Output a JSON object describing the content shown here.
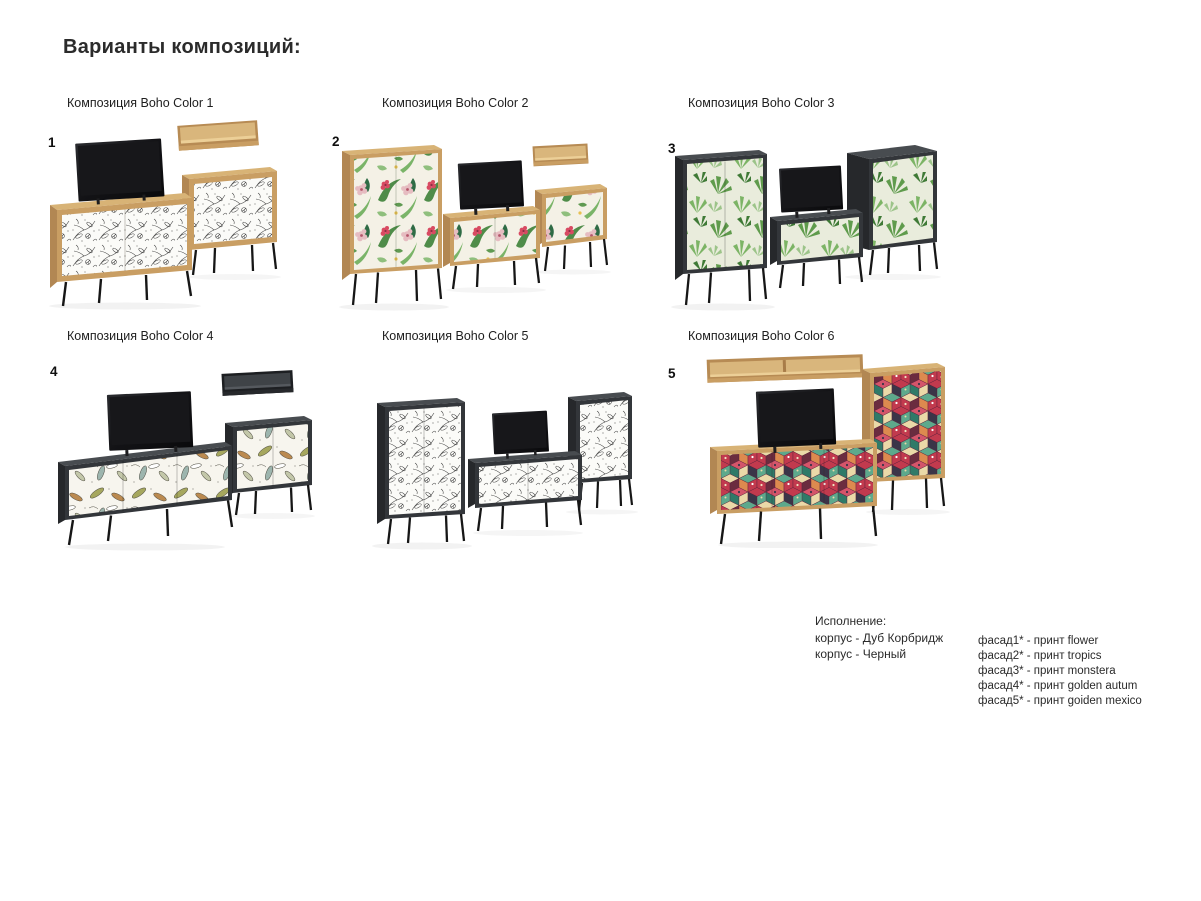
{
  "page": {
    "title": "Варианты композиций:"
  },
  "compositions": [
    {
      "number": "1",
      "label": "Композиция Boho Color 1",
      "print": "flower",
      "carcass": "oak"
    },
    {
      "number": "2",
      "label": "Композиция Boho Color 2",
      "print": "tropics",
      "carcass": "oak"
    },
    {
      "number": "3",
      "label": "Композиция Boho Color 3",
      "print": "monstera",
      "carcass": "dark"
    },
    {
      "number": "4",
      "label": "Композиция Boho Color 4",
      "print": "golden autum",
      "carcass": "dark"
    },
    {
      "number": "",
      "label": "Композиция Boho Color 5",
      "print": "flower",
      "carcass": "dark"
    },
    {
      "number": "5",
      "label": "Композиция Boho Color 6",
      "print": "goiden mexico",
      "carcass": "oak"
    }
  ],
  "legend": {
    "heading": "Исполнение:",
    "korpus_lines": [
      "корпус - Дуб Корбридж",
      "корпус - Черный"
    ],
    "facade_lines": [
      "фасад1* - принт flower",
      "фасад2* - принт tropics",
      "фасад3* - принт monstera",
      "фасад4* - принт golden autum",
      "фасад5* - принт goiden mexico"
    ]
  },
  "colors": {
    "oak": "#c99e63",
    "oak_top": "#d8b376",
    "oak_side": "#b28753",
    "dark_front": "#33363a",
    "dark_side": "#26282b",
    "dark_top": "#484c50",
    "leg_black": "#161616",
    "text": "#262626"
  }
}
